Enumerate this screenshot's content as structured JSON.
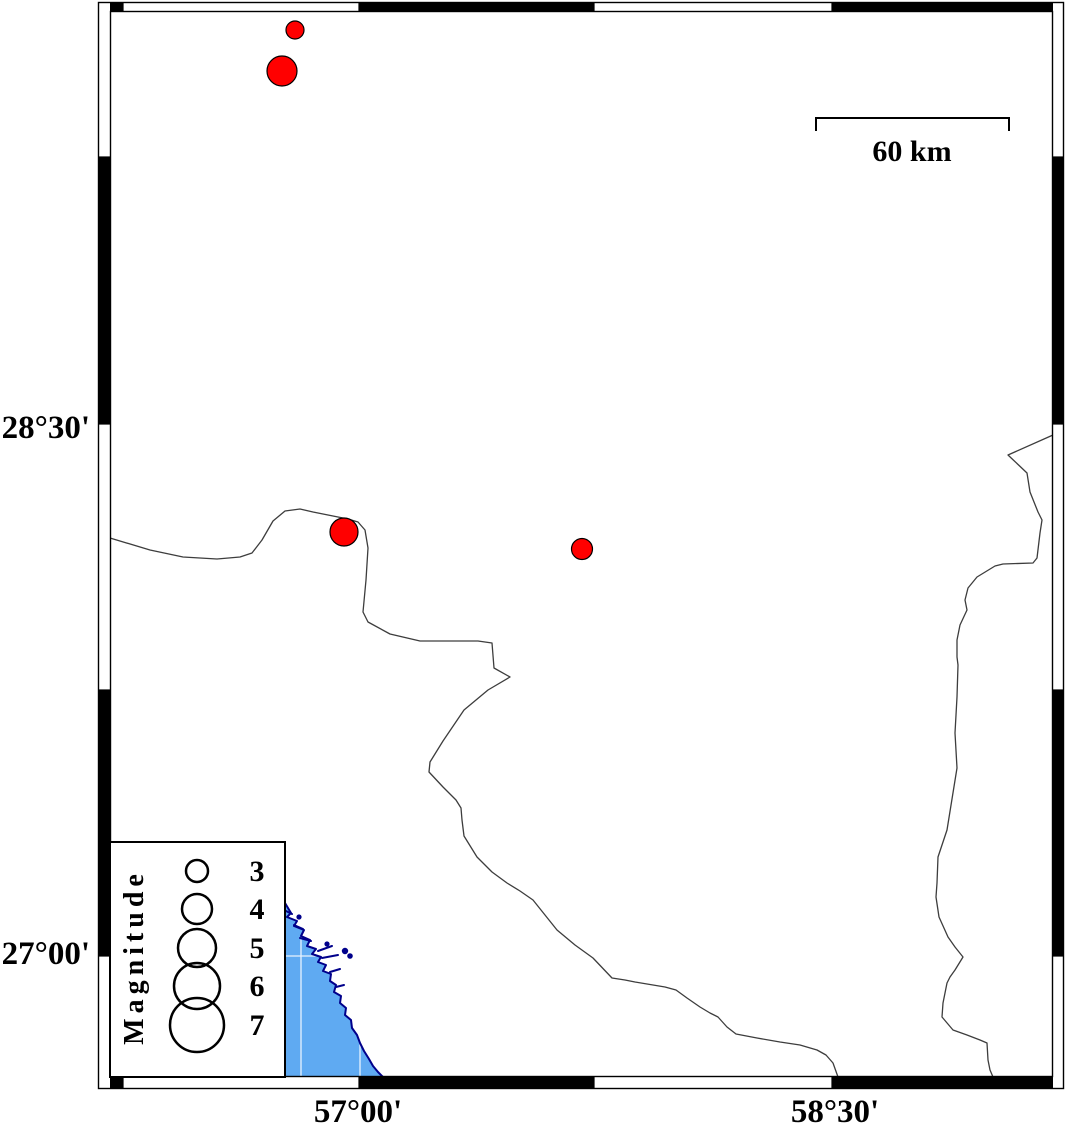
{
  "map": {
    "axis_labels": {
      "lat": [
        {
          "text": "28°30'",
          "y": 438
        },
        {
          "text": "27°00'",
          "y": 964
        }
      ],
      "lon": [
        {
          "text": "57°00'",
          "x": 358
        },
        {
          "text": "58°30'",
          "x": 835
        }
      ]
    },
    "scale_bar": {
      "label": "60 km"
    },
    "legend": {
      "title": "Magnitude",
      "entries": [
        {
          "label": "3",
          "r": 11,
          "cy": 871
        },
        {
          "label": "4",
          "r": 15,
          "cy": 909
        },
        {
          "label": "5",
          "r": 19,
          "cy": 948
        },
        {
          "label": "6",
          "r": 23,
          "cy": 986
        },
        {
          "label": "7",
          "r": 27,
          "cy": 1025
        }
      ]
    },
    "earthquakes": {
      "marker_color": "#ff0000",
      "points": [
        {
          "x": 295,
          "y": 30,
          "r": 9
        },
        {
          "x": 282,
          "y": 71,
          "r": 15
        },
        {
          "x": 344,
          "y": 532,
          "r": 14
        },
        {
          "x": 582,
          "y": 549,
          "r": 10.5
        }
      ]
    },
    "colors": {
      "water": "#5FAAF2",
      "coastline": "#00008B",
      "boundary": "#3d3d3d",
      "frame": "#000000",
      "grid_on_water": "#ffffff"
    }
  }
}
